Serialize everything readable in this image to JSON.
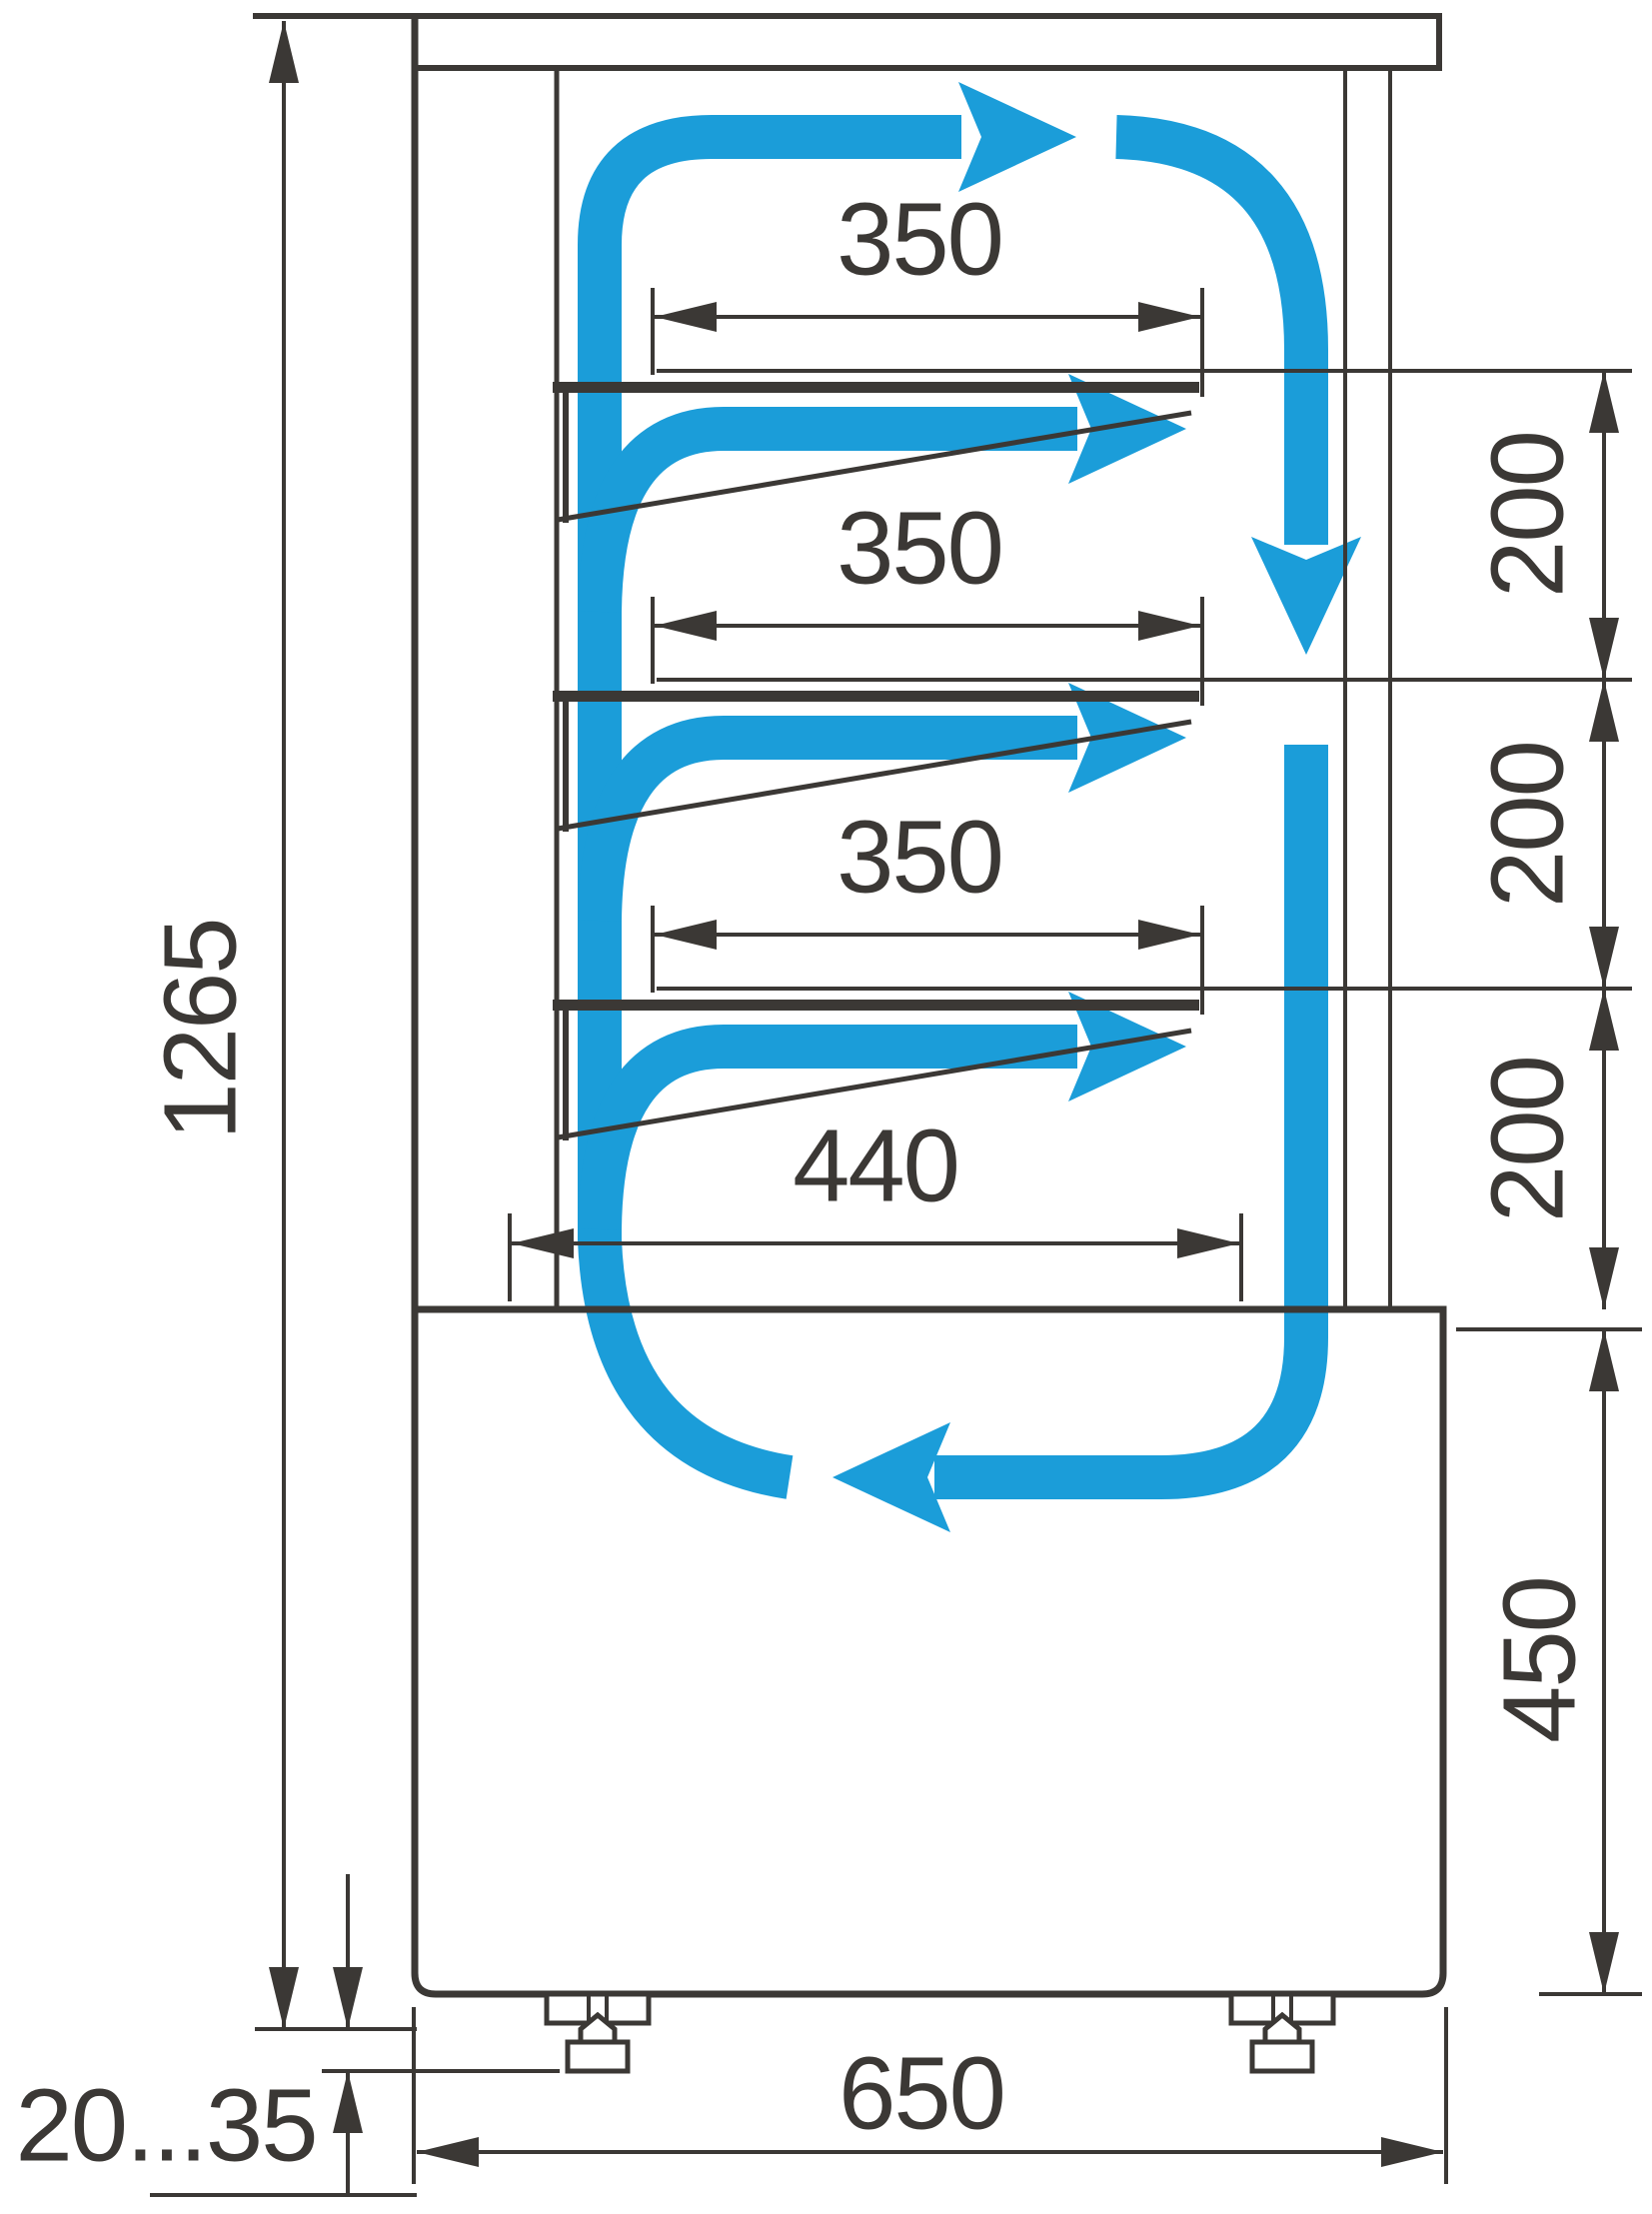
{
  "diagram": {
    "type": "technical-drawing",
    "subject": "refrigerated-display-case-side-section-with-air-circulation",
    "units": "mm",
    "colors": {
      "line": "#3b3835",
      "airflow": "#1b9dd9",
      "background": "#ffffff"
    },
    "labels": {
      "shelf_depth_1": "350",
      "shelf_depth_2": "350",
      "shelf_depth_3": "350",
      "bottom_shelf_depth": "440",
      "shelf_gap_1": "200",
      "shelf_gap_2": "200",
      "shelf_gap_3": "200",
      "base_height": "450",
      "overall_height": "1265",
      "base_depth": "650",
      "foot_adjust_range": "20...35"
    }
  }
}
